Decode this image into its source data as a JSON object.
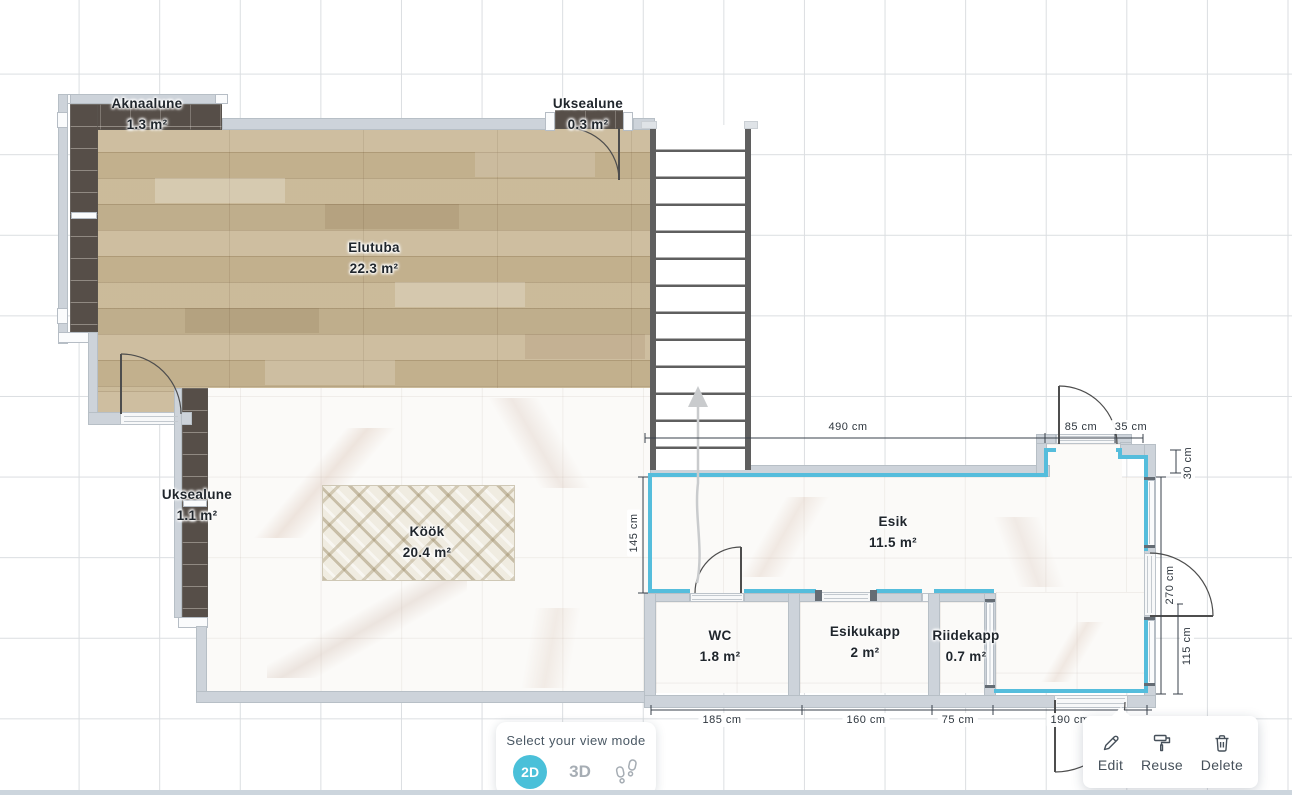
{
  "rooms": {
    "elutuba": {
      "name": "Elutuba",
      "area": "22.3 m²"
    },
    "kook": {
      "name": "Köök",
      "area": "20.4 m²"
    },
    "esik": {
      "name": "Esik",
      "area": "11.5 m²"
    },
    "wc": {
      "name": "WC",
      "area": "1.8 m²"
    },
    "esikukapp": {
      "name": "Esikukapp",
      "area": "2 m²"
    },
    "riidekapp": {
      "name": "Riidekapp",
      "area": "0.7 m²"
    },
    "aknaalune": {
      "name": "Aknaalune",
      "area": "1.3 m²"
    },
    "uksealune_top": {
      "name": "Uksealune",
      "area": "0.3 m²"
    },
    "uksealune_left": {
      "name": "Uksealune",
      "area": "1.1 m²"
    }
  },
  "dimensions": {
    "top_width": "490 cm",
    "alcove_door": "85 cm",
    "alcove_side": "35 cm",
    "esik_left_height": "145 cm",
    "right_offset": "30 cm",
    "right_height": "270 cm",
    "right_lower": "115 cm",
    "wc_width": "185 cm",
    "esikukapp_width": "160 cm",
    "riidekapp_width": "75 cm",
    "entry_width": "190 cm"
  },
  "view_mode": {
    "title": "Select your view mode",
    "modes": [
      {
        "label": "2D",
        "active": true
      },
      {
        "label": "3D",
        "active": false
      },
      {
        "label": "",
        "icon": "footsteps-icon",
        "active": false
      }
    ]
  },
  "context_menu": {
    "items": [
      {
        "label": "Edit",
        "icon": "pencil-icon"
      },
      {
        "label": "Reuse",
        "icon": "paint-roller-icon"
      },
      {
        "label": "Delete",
        "icon": "trash-icon"
      }
    ]
  },
  "colors": {
    "selection": "#55BDDC",
    "view_mode_active": "#4AC0D9",
    "wall": "#CDD3DA",
    "balcony_brick": "#564E48",
    "wood_floor": "#C8B795",
    "stairs_rail": "#5F5F5F"
  }
}
